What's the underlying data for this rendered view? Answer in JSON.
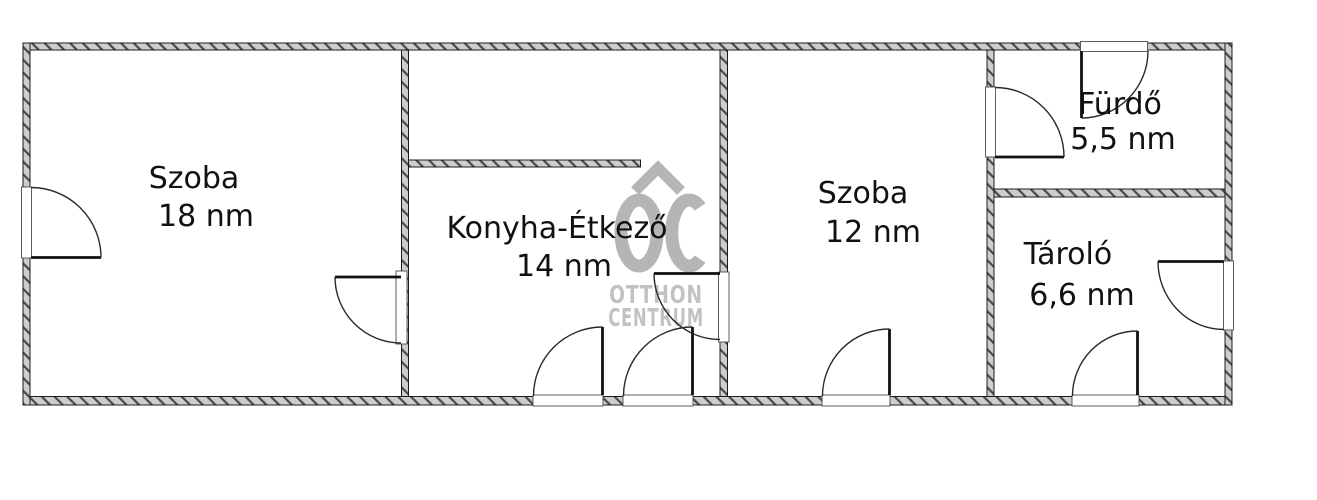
{
  "plan": {
    "type": "floorplan",
    "rooms": [
      {
        "id": "szoba-18",
        "name": "Szoba",
        "area": "18 nm"
      },
      {
        "id": "konyha-etkezo",
        "name": "Konyha-Étkező",
        "area": "14 nm"
      },
      {
        "id": "szoba-12",
        "name": "Szoba",
        "area": "12 nm"
      },
      {
        "id": "furdo",
        "name": "Fürdő",
        "area": "5,5 nm"
      },
      {
        "id": "tarolo",
        "name": "Tároló",
        "area": "6,6 nm"
      }
    ]
  },
  "watermark": {
    "monogram": "OC",
    "line1": "OTTHON",
    "line2": "CENTRUM"
  },
  "colors": {
    "background": "#ffffff",
    "wall_fill": "#cdcdcd",
    "wall_hatch": "#4a4a4a",
    "outline": "#1b1b1b",
    "label_text": "#111111",
    "watermark_gray": "#b5b5b5"
  }
}
